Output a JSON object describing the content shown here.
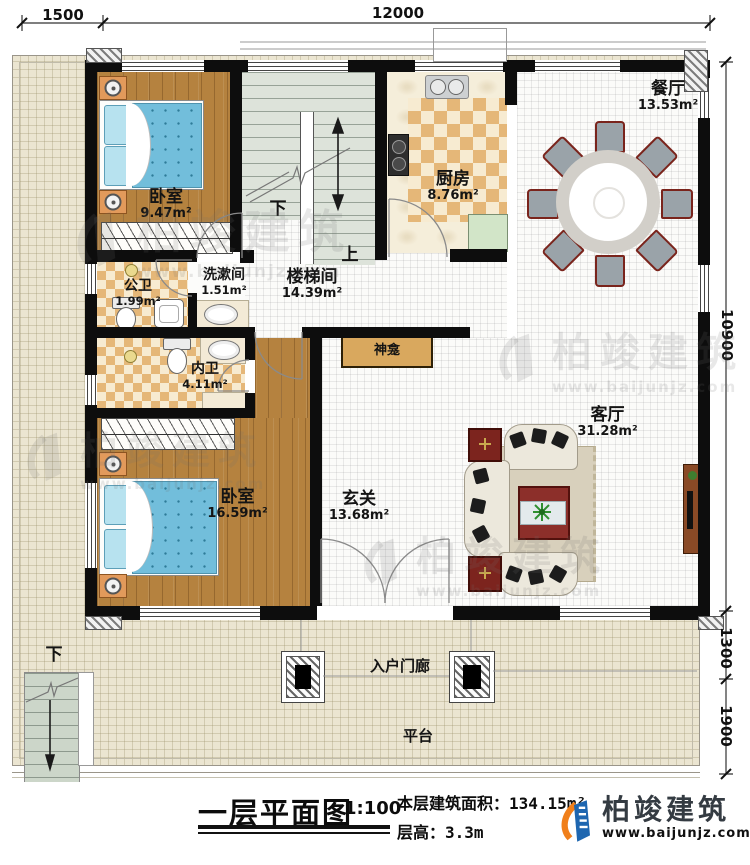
{
  "dims": {
    "top1": "1500",
    "top2": "12000",
    "right1": "10900",
    "right2": "1300",
    "right3": "1900"
  },
  "rooms": {
    "bedroom1": {
      "name": "卧室",
      "area": "9.47m²"
    },
    "stairwell": {
      "name": "楼梯间",
      "area": "14.39m²"
    },
    "kitchen": {
      "name": "厨房",
      "area": "8.76m²"
    },
    "dining": {
      "name": "餐厅",
      "area": "13.53m²"
    },
    "public_bath": {
      "name": "公卫",
      "area": "1.99m²"
    },
    "washroom": {
      "name": "洗漱间",
      "area": "1.51m²"
    },
    "inner_bath": {
      "name": "内卫",
      "area": "4.11m²"
    },
    "bedroom2": {
      "name": "卧室",
      "area": "16.59m²"
    },
    "hall": {
      "name": "玄关",
      "area": "13.68m²"
    },
    "living": {
      "name": "客厅",
      "area": "31.28m²"
    },
    "shrine": {
      "name": "神龛"
    },
    "porch": {
      "name": "入户门廊"
    },
    "platform": {
      "name": "平台"
    }
  },
  "stair_labels": {
    "down": "下",
    "up": "上",
    "outdoor_down": "下"
  },
  "title_block": {
    "title": "一层平面图",
    "scale": "1:100",
    "area_label": "本层建筑面积：",
    "area_value": "134.15m²",
    "floor_height_label": "层高：",
    "floor_height_value": "3.3m"
  },
  "brand": {
    "name": "柏竣建筑",
    "url": "www.baijunjz.com"
  },
  "watermark": {
    "name": "柏竣建筑",
    "url": "www.baijunjz.com"
  },
  "colors": {
    "wall": "#0d0d0d",
    "wood_floor": "#b5823f",
    "checker_tile": "#e5b778",
    "bed_blue": "#72bedb",
    "table_red": "#8c2f2a",
    "logo_blue": "#1e66b0",
    "logo_orange": "#f07f1a"
  }
}
